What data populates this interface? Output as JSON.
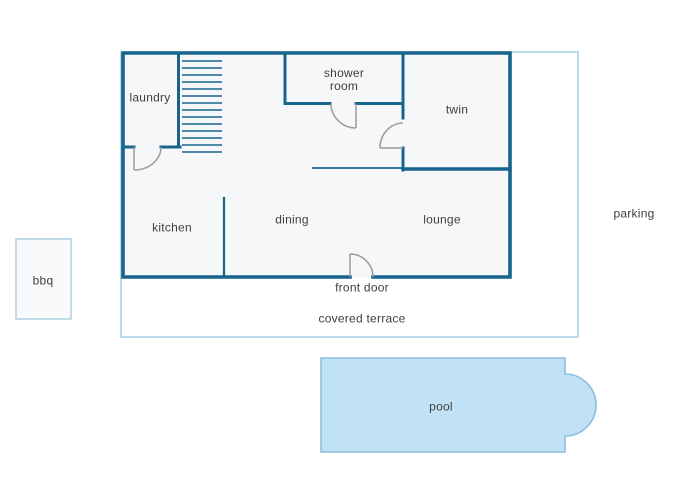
{
  "page": {
    "title": "house floor plan",
    "background": "#ffffff"
  },
  "colors": {
    "wall": "#17658d",
    "room_fill": "#f6f7f8",
    "terrace_outline": "#a9d1e6",
    "bbq_outline": "#b3d2e4",
    "pool_fill": "#c1e1f5",
    "pool_border": "#8abfdd",
    "door_swing": "#9b9b9b",
    "text": "#3e3e3e"
  },
  "floor_plan": {
    "rooms": {
      "laundry": "laundry",
      "shower_room": "shower\nroom",
      "twin": "twin",
      "kitchen": "kitchen",
      "dining": "dining",
      "lounge": "lounge"
    },
    "outdoor": {
      "front_door": "front door",
      "covered_terrace": "covered terrace",
      "parking": "parking",
      "bbq": "bbq",
      "pool": "pool"
    },
    "icons": {
      "stairs": "stairs-treads",
      "doors": [
        "laundry-door-swing",
        "shower-room-door-swing",
        "twin-door-swing",
        "front-door-swing"
      ]
    }
  }
}
